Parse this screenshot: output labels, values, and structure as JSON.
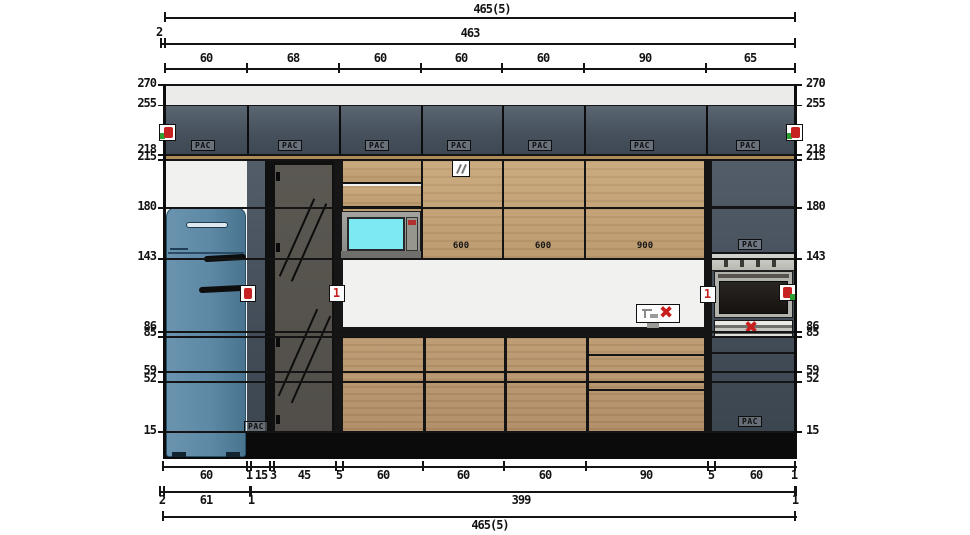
{
  "dimensions": {
    "top": {
      "overall": "465(5)",
      "gap_left": "2",
      "inner_total": "463",
      "segments": [
        "60",
        "68",
        "60",
        "60",
        "60",
        "90",
        "65"
      ]
    },
    "left_heights": [
      "270",
      "255",
      "218",
      "215",
      "180",
      "143",
      "86",
      "85",
      "59",
      "52",
      "15"
    ],
    "right_heights": [
      "270",
      "255",
      "218",
      "215",
      "180",
      "143",
      "86",
      "85",
      "59",
      "52",
      "15"
    ],
    "bottom": {
      "segments_row1": [
        "60",
        "1",
        "15",
        "3",
        "45",
        "5",
        "60",
        "60",
        "60",
        "90",
        "5",
        "60",
        "1"
      ],
      "segments_row2": [
        "2",
        "61",
        "1",
        "399",
        "1"
      ],
      "overall": "465(5)"
    }
  },
  "labels": {
    "cabinet_tag": "PAC",
    "width_600a": "600",
    "width_600b": "600",
    "width_900": "900",
    "marker_one": "1",
    "cross": "✖"
  },
  "colors": {
    "upper_cabinet_slate": "#47525e",
    "wood_front": "#c1a077",
    "wood_strip": "#ac8b59",
    "wall_white": "#f1f1ef",
    "ceiling_strip": "#ebebe9",
    "fridge_blue": "#5d89a6",
    "tall_glass": "#56534e",
    "microwave_glass": "#7de9f2",
    "counter_black": "#161616",
    "toe_kick_black": "#0b0b0b",
    "marker_red": "#c62222",
    "marker_green": "#2f9e33",
    "stainless": "#c6c6c0"
  }
}
